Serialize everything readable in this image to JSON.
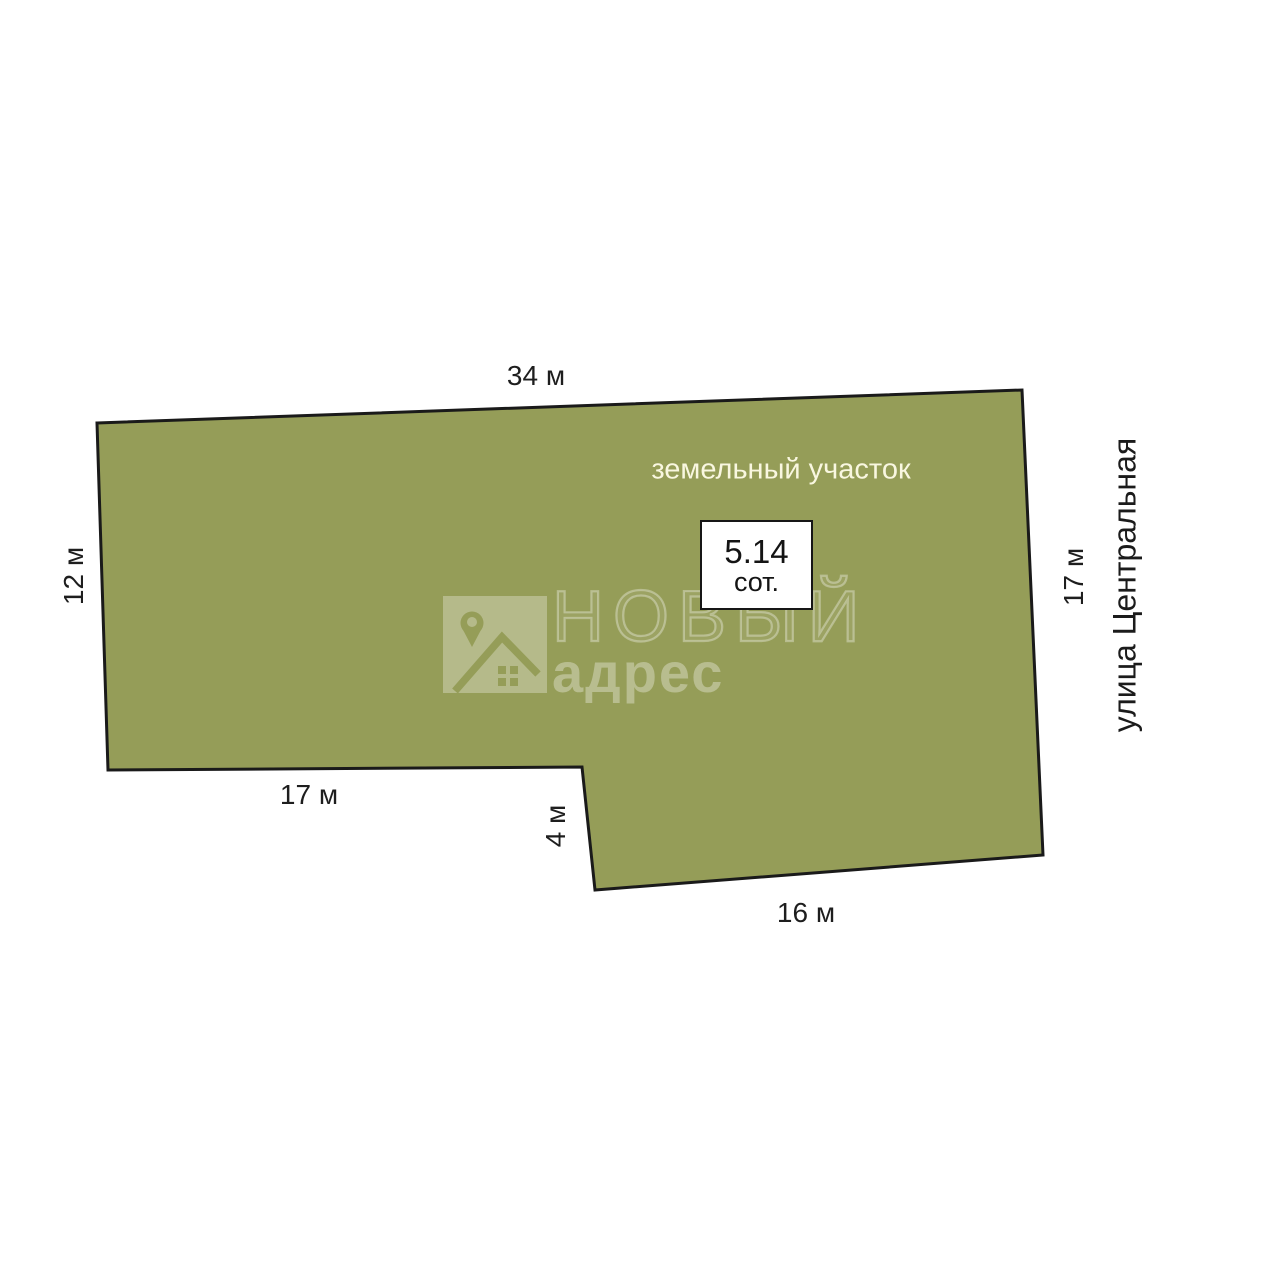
{
  "diagram": {
    "plot_label": "земельный участок",
    "street_label": "улица Центральная",
    "area_value": "5.14",
    "area_unit": "сот.",
    "dimensions": {
      "top": "34 м",
      "left": "12 м",
      "bottom_left": "17 м",
      "notch": "4 м",
      "bottom_right": "16 м",
      "right": "17 м"
    },
    "colors": {
      "plot_fill": "#959d58",
      "plot_outline": "#1a1a1a",
      "plot_label_text": "#f9f7e0"
    }
  },
  "watermark": {
    "brand_top": "НОВЫЙ",
    "brand_bottom": "адрес",
    "logo_icon": "map-pin-house-icon"
  }
}
